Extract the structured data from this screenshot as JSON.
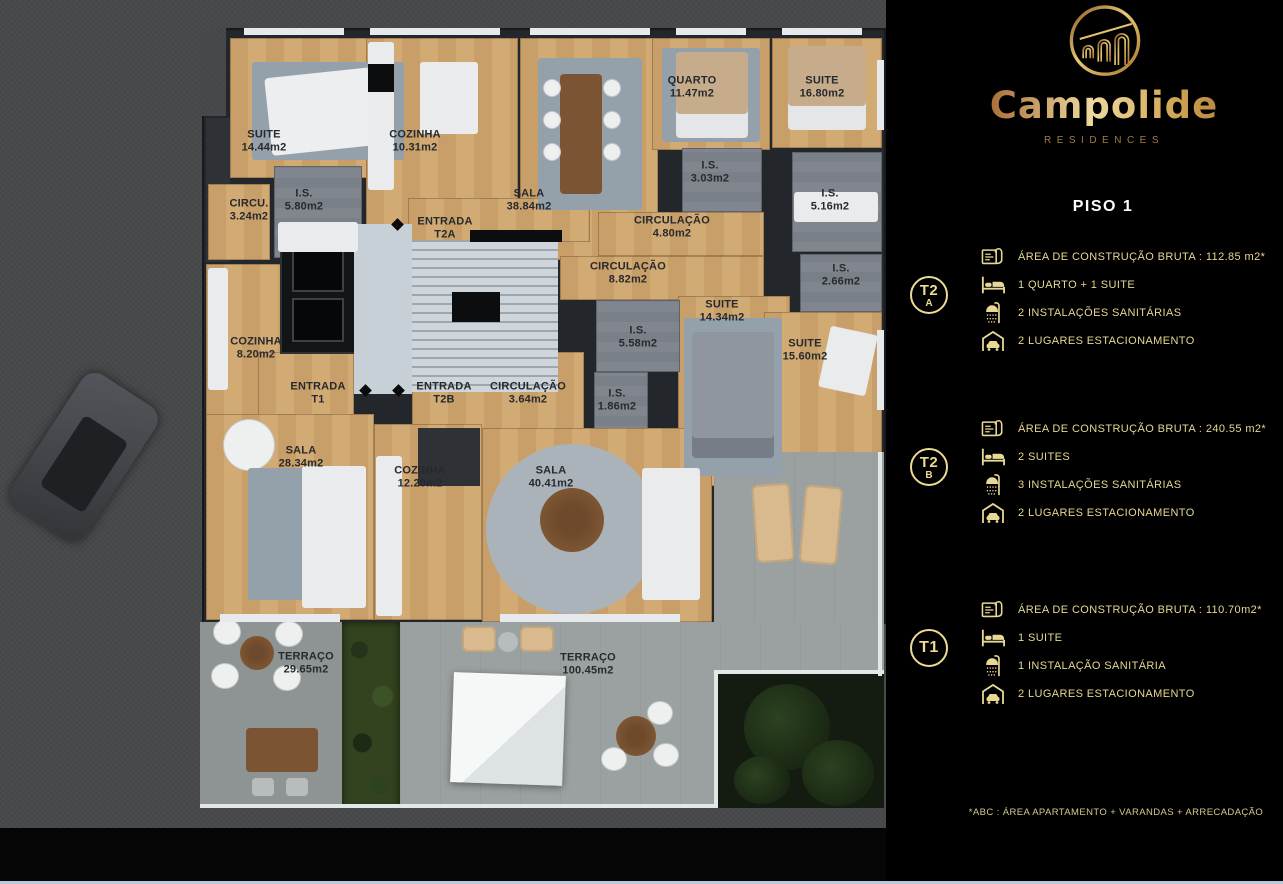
{
  "brand": {
    "name": "Campolide",
    "subtitle": "RESIDENCES",
    "floor_title": "PISO 1"
  },
  "footnote": "*ABC :  ÁREA APARTAMENTO + VARANDAS + ARRECADAÇÃO",
  "colors": {
    "gold_text": "#e6d792",
    "gold_badge": "#ecdb94",
    "panel_bg": "#000000",
    "wood_floor": "#cda56f",
    "bottom_accent": "#b6cbd9"
  },
  "units": [
    {
      "id": "T2A",
      "badge_top": "T2",
      "badge_bottom": "A",
      "specs": [
        {
          "icon": "blueprint-icon",
          "text": "ÁREA DE CONSTRUÇÃO BRUTA :  112.85 m2*"
        },
        {
          "icon": "bed-icon",
          "text": "1 QUARTO + 1 SUITE"
        },
        {
          "icon": "shower-icon",
          "text": "2 INSTALAÇÕES SANITÁRIAS"
        },
        {
          "icon": "garage-icon",
          "text": "2 LUGARES ESTACIONAMENTO"
        }
      ]
    },
    {
      "id": "T2B",
      "badge_top": "T2",
      "badge_bottom": "B",
      "specs": [
        {
          "icon": "blueprint-icon",
          "text": "ÁREA DE CONSTRUÇÃO BRUTA :  240.55 m2*"
        },
        {
          "icon": "bed-icon",
          "text": "2 SUITES"
        },
        {
          "icon": "shower-icon",
          "text": "3 INSTALAÇÕES SANITÁRIAS"
        },
        {
          "icon": "garage-icon",
          "text": "2 LUGARES ESTACIONAMENTO"
        }
      ]
    },
    {
      "id": "T1",
      "badge_top": "T1",
      "badge_bottom": "",
      "specs": [
        {
          "icon": "blueprint-icon",
          "text": "ÁREA DE CONSTRUÇÃO BRUTA :  110.70m2*"
        },
        {
          "icon": "bed-icon",
          "text": "1 SUITE"
        },
        {
          "icon": "shower-icon",
          "text": "1 INSTALAÇÃO SANITÁRIA"
        },
        {
          "icon": "garage-icon",
          "text": "2 LUGARES ESTACIONAMENTO"
        }
      ]
    }
  ],
  "floorplan": {
    "labels": [
      {
        "name": "SUITE",
        "area": "14.44m2",
        "x": 264,
        "y": 141
      },
      {
        "name": "CIRCU.",
        "area": "3.24m2",
        "x": 249,
        "y": 210
      },
      {
        "name": "I.S.",
        "area": "5.80m2",
        "x": 304,
        "y": 200
      },
      {
        "name": "COZINHA",
        "area": "10.31m2",
        "x": 415,
        "y": 141
      },
      {
        "name": "SALA",
        "area": "38.84m2",
        "x": 529,
        "y": 200
      },
      {
        "name": "ENTRADA",
        "area": "T2A",
        "x": 445,
        "y": 228
      },
      {
        "name": "QUARTO",
        "area": "11.47m2",
        "x": 692,
        "y": 87
      },
      {
        "name": "SUITE",
        "area": "16.80m2",
        "x": 822,
        "y": 87
      },
      {
        "name": "I.S.",
        "area": "3.03m2",
        "x": 710,
        "y": 172
      },
      {
        "name": "I.S.",
        "area": "5.16m2",
        "x": 830,
        "y": 200
      },
      {
        "name": "CIRCULAÇÃO",
        "area": "4.80m2",
        "x": 672,
        "y": 227
      },
      {
        "name": "CIRCULAÇÃO",
        "area": "8.82m2",
        "x": 628,
        "y": 273
      },
      {
        "name": "I.S.",
        "area": "2.66m2",
        "x": 841,
        "y": 275
      },
      {
        "name": "SUITE",
        "area": "14.34m2",
        "x": 722,
        "y": 311
      },
      {
        "name": "I.S.",
        "area": "5.58m2",
        "x": 638,
        "y": 337
      },
      {
        "name": "SUITE",
        "area": "15.60m2",
        "x": 805,
        "y": 350
      },
      {
        "name": "COZINHA",
        "area": "8.20m2",
        "x": 256,
        "y": 348
      },
      {
        "name": "ENTRADA",
        "area": "T1",
        "x": 318,
        "y": 393
      },
      {
        "name": "ENTRADA",
        "area": "T2B",
        "x": 444,
        "y": 393
      },
      {
        "name": "CIRCULAÇÃO",
        "area": "3.64m2",
        "x": 528,
        "y": 393
      },
      {
        "name": "I.S.",
        "area": "1.86m2",
        "x": 617,
        "y": 400
      },
      {
        "name": "SALA",
        "area": "28.34m2",
        "x": 301,
        "y": 457
      },
      {
        "name": "COZINHA",
        "area": "12.20m2",
        "x": 420,
        "y": 477
      },
      {
        "name": "SALA",
        "area": "40.41m2",
        "x": 551,
        "y": 477
      },
      {
        "name": "TERRAÇO",
        "area": "29.65m2",
        "x": 306,
        "y": 663
      },
      {
        "name": "TERRAÇO",
        "area": "100.45m2",
        "x": 588,
        "y": 664
      }
    ]
  }
}
